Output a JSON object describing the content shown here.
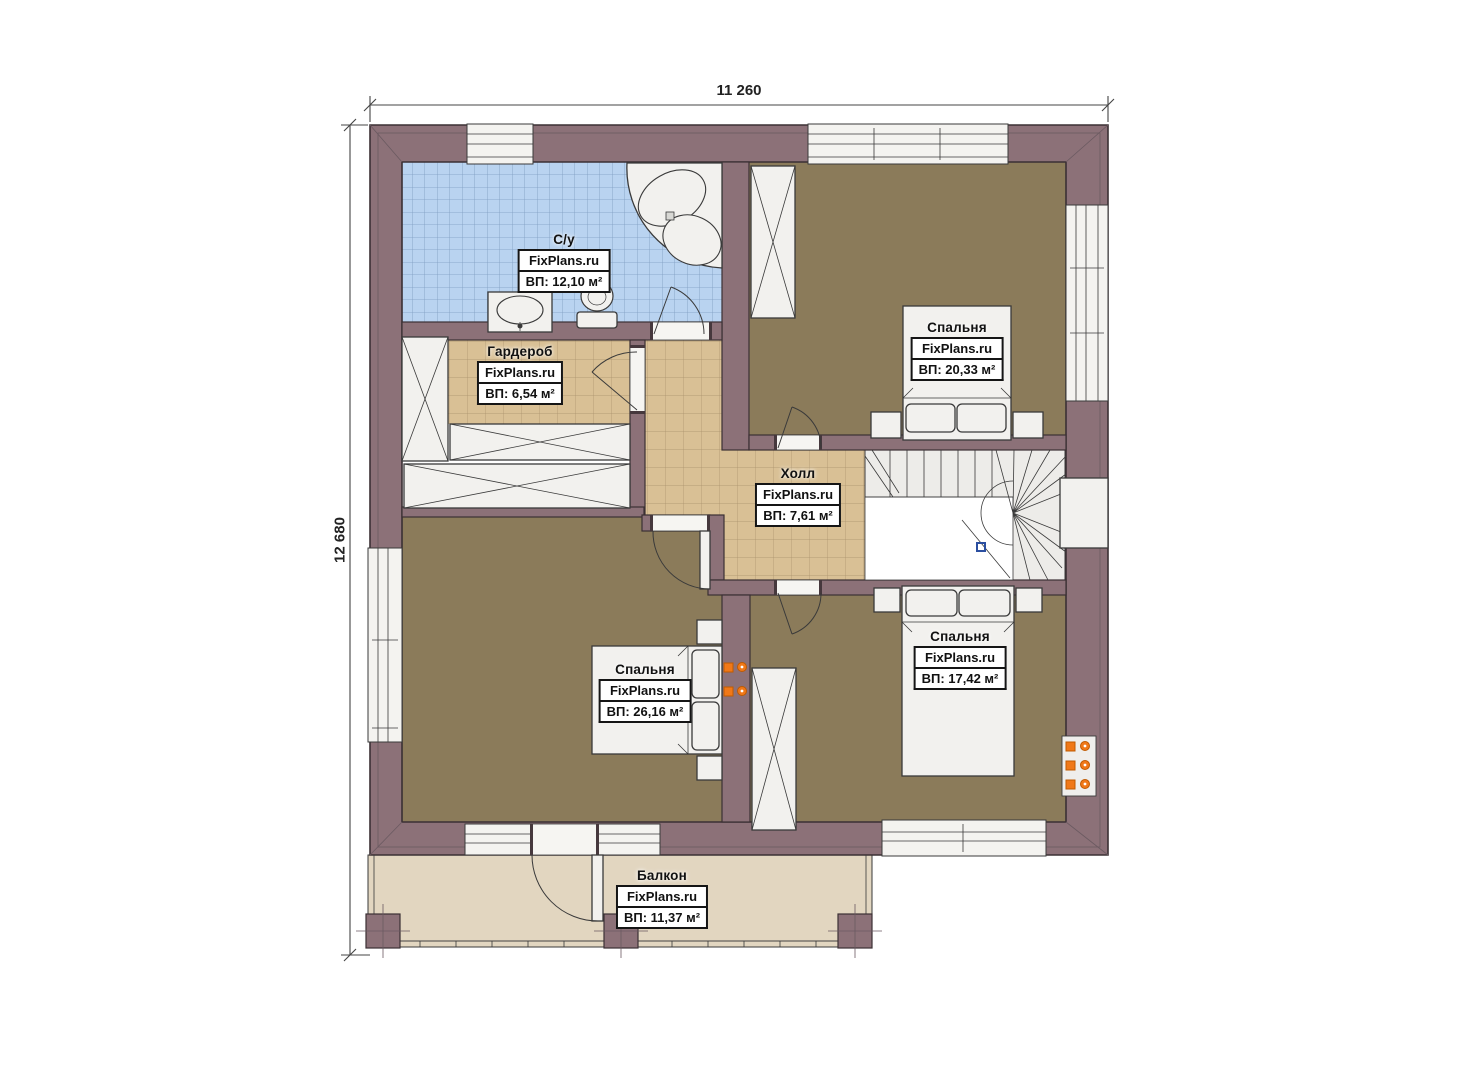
{
  "dimensions": {
    "top": "11 260",
    "left": "12 680"
  },
  "brand": "FixPlans.ru",
  "rooms": {
    "bathroom": {
      "name": "С/у",
      "area": "ВП: 12,10 м²"
    },
    "wardrobe": {
      "name": "Гардероб",
      "area": "ВП: 6,54 м²"
    },
    "bedroom_top_right": {
      "name": "Спальня",
      "area": "ВП: 20,33 м²"
    },
    "hall": {
      "name": "Холл",
      "area": "ВП: 7,61 м²"
    },
    "bedroom_left": {
      "name": "Спальня",
      "area": "ВП: 26,16 м²"
    },
    "bedroom_bottom_right": {
      "name": "Спальня",
      "area": "ВП: 17,42 м²"
    },
    "balcony": {
      "name": "Балкон",
      "area": "ВП: 11,37 м²"
    }
  },
  "colors": {
    "wall": "#8C7178",
    "outline": "#3B3034",
    "floor_wood": "#8B7B5A",
    "tile_tan": "#D9C095",
    "tile_blue": "#B9D3F0",
    "balcony_floor": "#E2D6C0",
    "stairs": "#EDECE9",
    "fixture": "#F2F1EE",
    "outlet_orange": "#F07818",
    "marker_blue": "#2B4EA0"
  }
}
